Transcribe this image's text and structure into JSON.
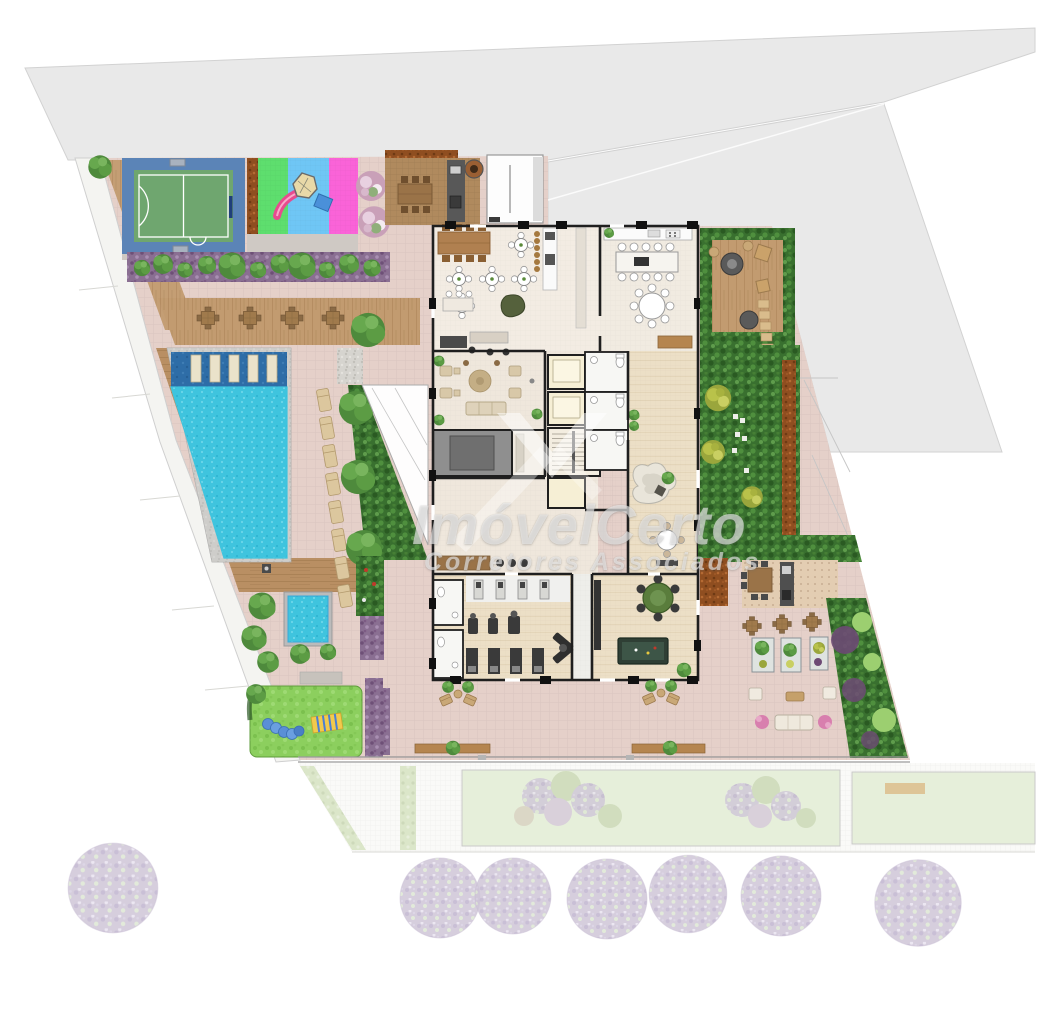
{
  "watermark": {
    "brand": "ImóvelCerto",
    "tagline": "Corretores Associados"
  },
  "palette": {
    "background": "#ffffff",
    "neighbor_lot": "#e9e9e9",
    "site_paving": "#e5d0c9",
    "plaza_paving": "#decbc3",
    "pool_water": "#3fc4de",
    "pool_shallow": "#2e6da7",
    "kids_pool": "#3aa9d8",
    "court_blue": "#5b84b7",
    "court_green": "#6fa66f",
    "playground_green": "#5ede6e",
    "playground_blue": "#6fc6f5",
    "playground_pink": "#fa63d8",
    "lawn": "#8ccf5e",
    "deck_wood": "#c29b70",
    "hedge_green": "#39702f",
    "purple_bed": "#8a6f92",
    "building_wall": "#1f1f1f",
    "interior_floor": "#f3ece3",
    "elevator_core": "#f6efd5",
    "sidewalk": "#fafaf8",
    "faded_tree": "#cfc6d8"
  }
}
